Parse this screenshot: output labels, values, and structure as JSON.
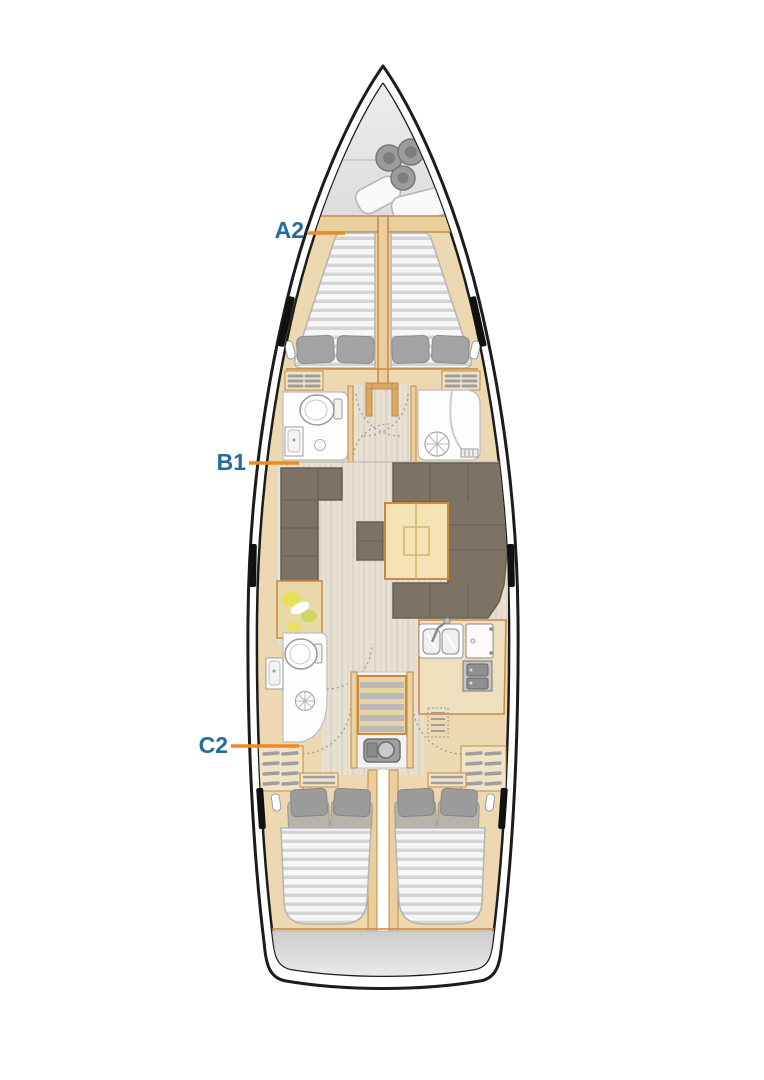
{
  "diagram": {
    "type": "yacht-interior-layout-plan",
    "view": "top-down deck plan of a sailing yacht",
    "cabin_labels": [
      {
        "text": "A2",
        "target_area": "forward-vberth-cabin"
      },
      {
        "text": "B1",
        "target_area": "forward-head-bathroom"
      },
      {
        "text": "C2",
        "target_area": "aft-head-bathroom"
      }
    ],
    "colors": {
      "label_text": "#236c9f",
      "leader_line": "#ee8a25",
      "hull_outline": "#1c1c1c",
      "wood_light": "#ecd9b2",
      "wood_trim": "#c9893f",
      "upholstery_brown": "#7d7365",
      "floor_light": "#e7e1d4",
      "fixture_white": "#fdfdfd",
      "locker_gray": "#e4e4e4",
      "mattress_slat": "#d4d4d4",
      "pillow_gray": "#a3a3a3"
    },
    "areas": [
      {
        "name": "anchor-locker",
        "items": [
          "round-fenders",
          "long-fenders"
        ]
      },
      {
        "name": "forward-cabin",
        "items": [
          "v-berth-mattresses",
          "pillows",
          "reading-lights",
          "shelf-lockers"
        ]
      },
      {
        "name": "port-forward-head",
        "items": [
          "toilet",
          "sink",
          "floor-drain"
        ]
      },
      {
        "name": "starboard-forward-shower",
        "items": [
          "shower-drain",
          "curved-bench",
          "vent-grate"
        ]
      },
      {
        "name": "salon",
        "items": [
          "port-settee",
          "u-shaped-dinette",
          "saloon-table",
          "center-stool",
          "chart-table-with-map"
        ]
      },
      {
        "name": "galley",
        "items": [
          "double-sink",
          "faucet",
          "refrigerator",
          "two-burner-stove"
        ]
      },
      {
        "name": "aft-head",
        "items": [
          "toilet",
          "sink",
          "shower-drain"
        ]
      },
      {
        "name": "companionway",
        "items": [
          "stairs",
          "engine"
        ]
      },
      {
        "name": "port-aft-cabin",
        "items": [
          "double-berth",
          "pillows",
          "shelf-lockers"
        ]
      },
      {
        "name": "starboard-aft-cabin",
        "items": [
          "double-berth",
          "pillows",
          "shelf-lockers"
        ]
      },
      {
        "name": "stern-cockpit-area",
        "items": []
      }
    ]
  }
}
